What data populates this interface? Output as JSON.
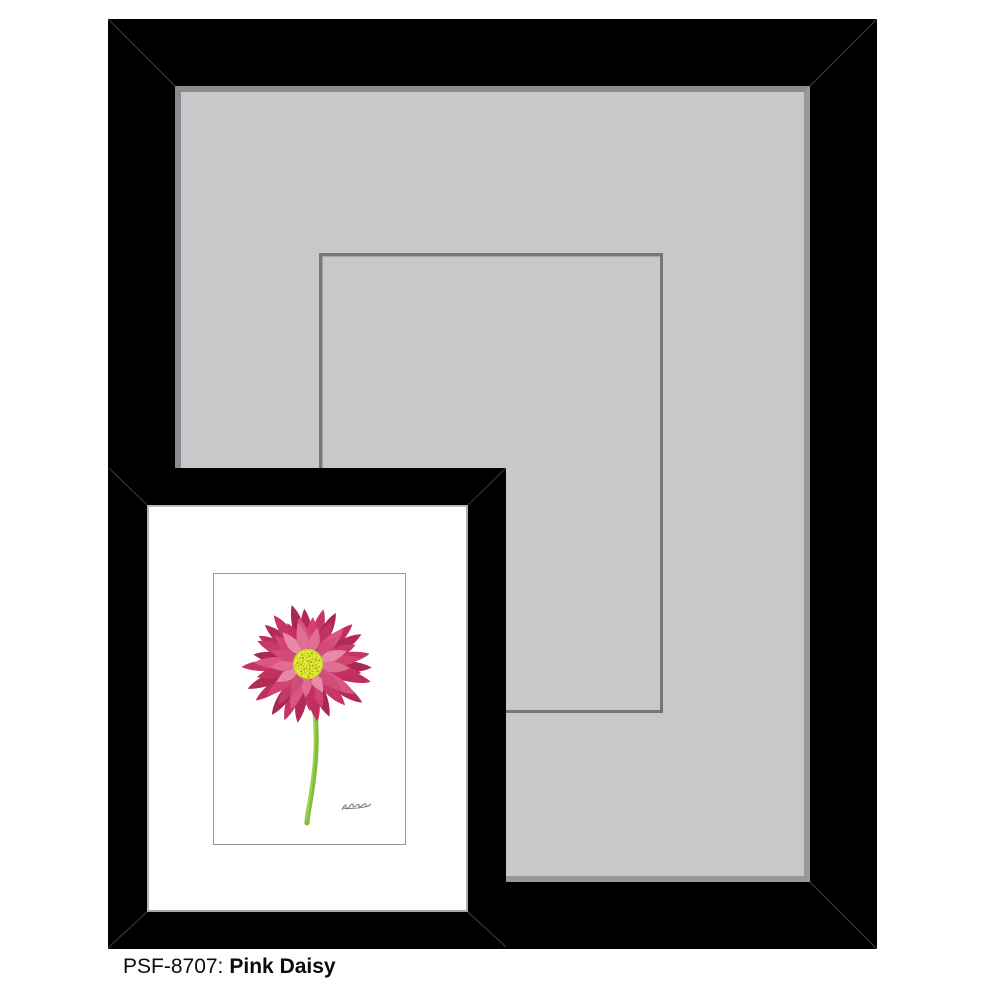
{
  "caption": {
    "sku": "PSF-8707:",
    "title": "Pink Daisy"
  },
  "product": {
    "moulding_color": "#000000",
    "large_mat_color": "#c7c8ca",
    "mat_bevel_color": "#74767a",
    "small_mat_color": "#ffffff",
    "page_background": "#ffffff"
  },
  "flower": {
    "center": [
      94,
      90
    ],
    "disc": {
      "radius": 14.5,
      "fill": "#e4ea39",
      "ring": "#c6d028",
      "dot_colors": [
        "#b2be1d",
        "#ccd62a",
        "#98a513"
      ]
    },
    "stem": {
      "color": "#7fbf3c",
      "highlight": "#abdb61"
    },
    "petal_layers": [
      {
        "count": 23,
        "length": 61,
        "width": 7.5,
        "angle_offset": 0,
        "colors": [
          "#b12b54",
          "#c63565",
          "#a92750",
          "#c02e5e"
        ]
      },
      {
        "count": 19,
        "length": 50,
        "width": 7.5,
        "angle_offset": 9,
        "colors": [
          "#d2436f",
          "#c23160",
          "#db5584",
          "#c73a68"
        ]
      },
      {
        "count": 13,
        "length": 38,
        "width": 7.0,
        "angle_offset": 17,
        "colors": [
          "#e06d92",
          "#d14d79",
          "#e889aa"
        ]
      }
    ]
  }
}
